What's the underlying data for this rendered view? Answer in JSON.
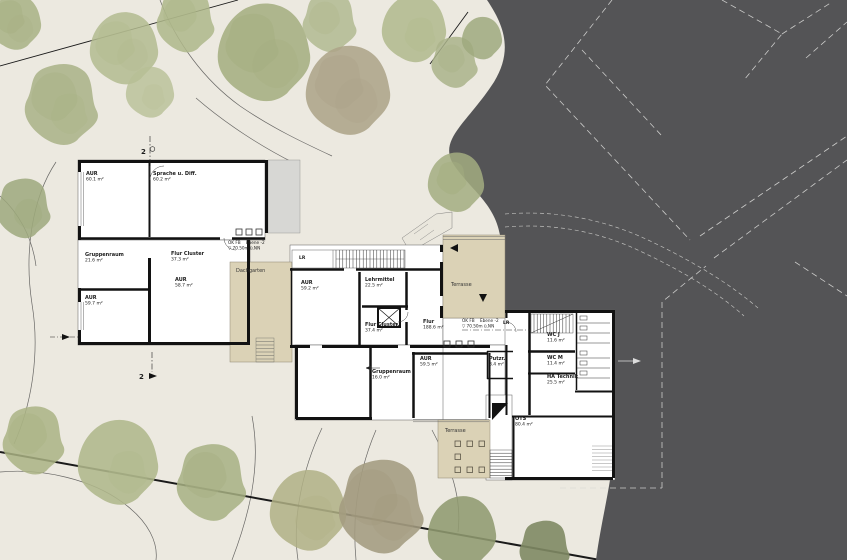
{
  "plan": {
    "rooms": [
      {
        "name": "AUR",
        "area": "60.1 m²"
      },
      {
        "name": "Sprache u. Diff.",
        "area": "60.2 m²"
      },
      {
        "name": "Gruppenraum",
        "area": "21.6 m²"
      },
      {
        "name": "Flur Cluster",
        "area": "37.3 m²"
      },
      {
        "name": "AUR",
        "area": "58.7 m²"
      },
      {
        "name": "AUR",
        "area": "59.7 m²"
      },
      {
        "name": "AUR",
        "area": "59.2 m²"
      },
      {
        "name": "Lehrmittel",
        "area": "22.5 m²"
      },
      {
        "name": "Flur Cluster",
        "area": "37.4 m²"
      },
      {
        "name": "Flur",
        "area": "188.6 m²"
      },
      {
        "name": "AUR",
        "area": "59.5 m²"
      },
      {
        "name": "Putzr.",
        "area": "8.4 m²"
      },
      {
        "name": "Gruppenraum",
        "area": "16.0 m²"
      },
      {
        "name": "WC J",
        "area": "11.6 m²"
      },
      {
        "name": "WC M",
        "area": "11.4 m²"
      },
      {
        "name": "HA Technik",
        "area": "25.5 m²"
      },
      {
        "name": "OTS",
        "area": "80.4 m²"
      }
    ],
    "terraces": {
      "roof_garden": "Dachgarten",
      "northeast": "Terrasse",
      "south": "Terrasse"
    },
    "small_rooms": {
      "lr1": "LR",
      "lr2": "LR"
    },
    "level_marker": {
      "line1": "OK FB",
      "line2": "Ebene -2",
      "line3": "▽ 70.50m ü.NN"
    },
    "section_markers": {
      "top": "2",
      "bottom": "2"
    },
    "colors": {
      "background": "#ece9e0",
      "shadow_area": "#545456",
      "terrace_fill": "#dbd2b6",
      "wall": "#121212",
      "room_fill": "#ffffff",
      "tree_green": "#a9b286",
      "dashed_outline": "#d8d8d6"
    }
  }
}
